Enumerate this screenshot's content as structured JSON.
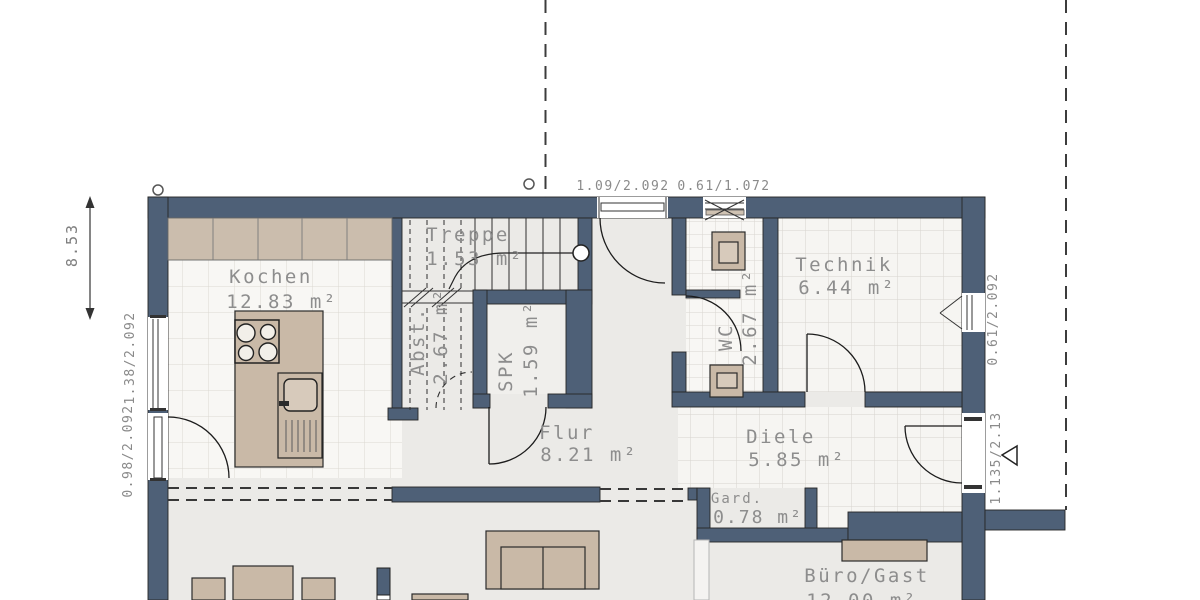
{
  "title": "Erdgeschoss Grundriss",
  "rooms": [
    {
      "name": "Kochen",
      "area": "12.83 m²"
    },
    {
      "name": "Treppe",
      "area": "1.53 m²"
    },
    {
      "name": "Abst.",
      "area": "2.67 m²"
    },
    {
      "name": "SPK",
      "area": "1.59 m²"
    },
    {
      "name": "Flur",
      "area": "8.21 m²"
    },
    {
      "name": "WC",
      "area": "2.67 m²"
    },
    {
      "name": "Technik",
      "area": "6.44 m²"
    },
    {
      "name": "Diele",
      "area": "5.85 m²"
    },
    {
      "name": "Gard.",
      "area": "0.78 m²"
    },
    {
      "name": "Büro/Gast",
      "area": "12.00 m²"
    }
  ],
  "dimensions": {
    "overall_left": "8.53",
    "top": [
      "1.09/2.092",
      "0.61/1.072"
    ],
    "left": [
      "1.38/2.092",
      "0.98/2.092"
    ],
    "right": [
      "0.61/2.092",
      "1.135/2.13"
    ]
  },
  "colors": {
    "wall": "#4e6077",
    "furniture": "#c9b9a7",
    "floor_tile": "#f8f7f4",
    "floor_plain": "#ebeae7",
    "tile_line": "#dbd8d2",
    "label_text": "#8d8d8d"
  },
  "icons": {
    "entrance_arrow": "triangle-left",
    "reference_marker": "circle",
    "stair_walkline_start": "circle"
  }
}
